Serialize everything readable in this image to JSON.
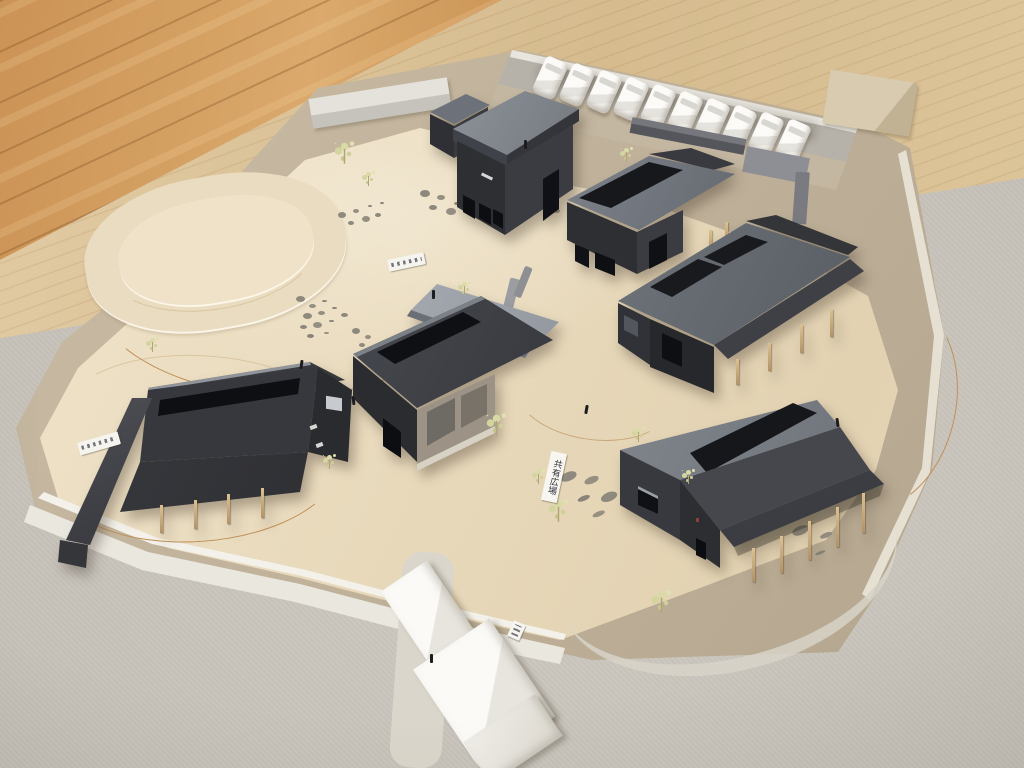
{
  "scene": {
    "medium": "photograph",
    "subject": "Hand-built cardboard architecture site model photographed from above, sitting on a grey board over a wooden floor",
    "counts": {
      "dark_houses": 6,
      "small_shed": 1,
      "parked_foam_cars": 10,
      "foam_massing_blocks": 3,
      "paper_labels": 4
    },
    "features": [
      "contoured cream terrain with drawn paths and stones",
      "dried-flower model trees",
      "timber porch posts under roofs",
      "white styrofoam contour road along lower edge",
      "row of white foam cars along top parking strip"
    ]
  },
  "labels": {
    "plaza": {
      "text": "共有広場",
      "readable": true
    },
    "tag_left": {
      "text": "",
      "readable": false
    },
    "tag_upper": {
      "text": "",
      "readable": false
    },
    "tag_bottom": {
      "text": "",
      "readable": false
    }
  },
  "palette": {
    "wood_floor": "#c9914f",
    "table_edge_wood": "#dcc49c",
    "grey_board": "#c8c4bc",
    "chipboard_base": "#c1b29a",
    "site_surface": "#ecdfc4",
    "house_walls": "#333438",
    "house_roof_light": "#7b8087",
    "skylight": "#15161a",
    "timber_posts": "#cbad7d",
    "foam_white": "#f3f1ea",
    "tree_foliage": "#d8d8a4",
    "path_line": "#b88a58"
  }
}
